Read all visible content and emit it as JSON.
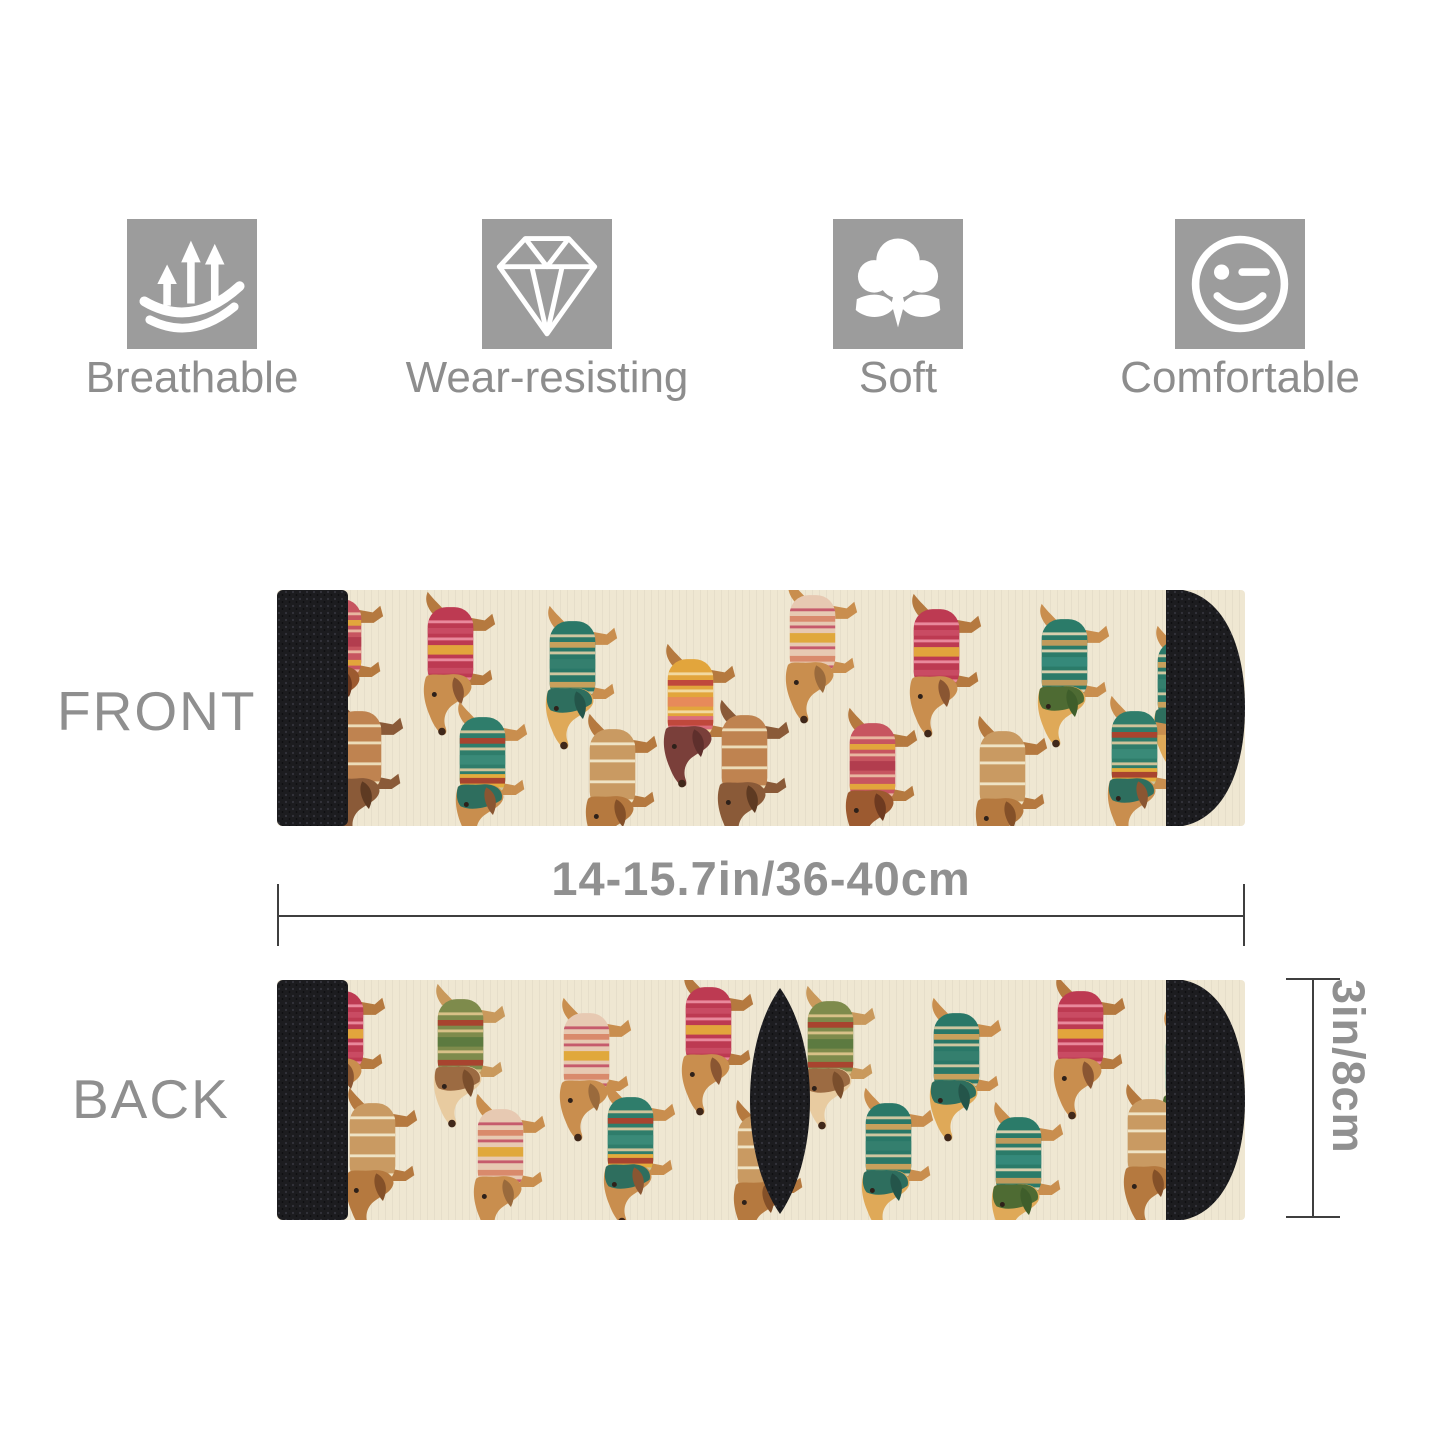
{
  "features": [
    {
      "label": "Breathable",
      "icon": "breathable-arrows-icon"
    },
    {
      "label": "Wear-resisting",
      "icon": "diamond-icon"
    },
    {
      "label": "Soft",
      "icon": "cotton-flower-icon"
    },
    {
      "label": "Comfortable",
      "icon": "wink-smiley-icon"
    }
  ],
  "front_label": "FRONT",
  "back_label": "BACK",
  "width_dimension": "14-15.7in/36-40cm",
  "height_dimension": "3in/8cm",
  "colors": {
    "icon_bg": "#9c9c9c",
    "icon_glyph": "#ffffff",
    "label_text": "#8d8d8d",
    "side_label_text": "#8f8f8f",
    "dimension_text": "#909090",
    "dimension_line": "#3f3f3f",
    "sock_base": "#efe7d2",
    "sock_black": "#1c1c1f"
  },
  "sock_pattern": {
    "dog_size": [
      95,
      152
    ],
    "variants": {
      "red": {
        "body": "#bd3a52",
        "blk": "none",
        "s1": "#e9899c",
        "s2": "#c94b63",
        "s3": "#e2a53c",
        "fur": "#b5793f",
        "head": "#c98e4e",
        "ear": "#8a5632",
        "hood": "none"
      },
      "teal": {
        "body": "#2b7b69",
        "blk": "none",
        "s1": "#d8cfae",
        "s2": "#bf9a5c",
        "s3": "#35897a",
        "fur": "#c98e4e",
        "head": "#dfa958",
        "ear": "#3f5e2b",
        "hood": "#4e6b33"
      },
      "tealhood": {
        "body": "#2a7868",
        "blk": "none",
        "s1": "#cfc6a0",
        "s2": "#c8a05c",
        "s3": "#347f6e",
        "fur": "#c98e4e",
        "head": "#dfa958",
        "ear": "#24554a",
        "hood": "#2e6e5e"
      },
      "tealyellow": {
        "body": "#2f7d6b",
        "blk": "#e3ac3c",
        "s1": "#cfc39a",
        "s2": "#a8442f",
        "s3": "#3a8a78",
        "fur": "#c98e4e",
        "head": "#c98e4e",
        "ear": "#8a5632",
        "hood": "#2e6e5e"
      },
      "yellow": {
        "body": "#e2a53c",
        "blk": "#db6d7c",
        "s1": "#f2d9a0",
        "s2": "#c0483c",
        "s3": "#e78a5a",
        "fur": "#b5793f",
        "head": "#7a3f3a",
        "ear": "#5e2f2c",
        "hood": "none"
      },
      "cream": {
        "body": "#e7c9b2",
        "blk": "none",
        "s1": "#c65b6c",
        "s2": "#d98a6c",
        "s3": "#e0a83c",
        "fur": "#c98e4e",
        "head": "#c98e4e",
        "ear": "#9a6a3c",
        "hood": "none"
      },
      "olive": {
        "body": "#7e8b4c",
        "blk": "none",
        "s1": "#d8c188",
        "s2": "#a8442f",
        "s3": "#5c7a40",
        "fur": "#c9995c",
        "head": "#e8cba0",
        "ear": "#7a4e2c",
        "hood": "#9c6b42"
      },
      "brownplain": {
        "body": "#bf8350",
        "blk": "none",
        "s1": "#ecdcb8",
        "s2": "none",
        "s3": "none",
        "fur": "#8a5a38",
        "head": "#8a5a38",
        "ear": "#5e3a22",
        "hood": "none"
      },
      "tan": {
        "body": "#c99a62",
        "blk": "none",
        "s1": "#efe3c4",
        "s2": "none",
        "s3": "none",
        "fur": "#b5793f",
        "head": "#b5793f",
        "ear": "#845028",
        "hood": "none"
      },
      "redpink": {
        "body": "#c75560",
        "blk": "none",
        "s1": "#e8b6a0",
        "s2": "#e2a53c",
        "s3": "#b23d4e",
        "fur": "#b5793f",
        "head": "#9c5a30",
        "ear": "#6e3a20",
        "hood": "none"
      }
    },
    "front_dogs": [
      [
        14,
        -8,
        "redpink"
      ],
      [
        126,
        0,
        "red"
      ],
      [
        248,
        14,
        "tealhood"
      ],
      [
        366,
        52,
        "yellow"
      ],
      [
        488,
        -12,
        "cream"
      ],
      [
        612,
        2,
        "red"
      ],
      [
        740,
        12,
        "teal"
      ],
      [
        856,
        34,
        "tealhood"
      ],
      [
        34,
        104,
        "brownplain"
      ],
      [
        158,
        110,
        "tealyellow"
      ],
      [
        288,
        122,
        "tan"
      ],
      [
        420,
        108,
        "brownplain"
      ],
      [
        548,
        116,
        "redpink"
      ],
      [
        678,
        124,
        "tan"
      ],
      [
        810,
        104,
        "tealyellow"
      ]
    ],
    "back_dogs": [
      [
        16,
        -6,
        "red"
      ],
      [
        136,
        2,
        "olive"
      ],
      [
        262,
        16,
        "cream"
      ],
      [
        384,
        -10,
        "red"
      ],
      [
        506,
        4,
        "olive"
      ],
      [
        632,
        16,
        "tealhood"
      ],
      [
        756,
        -6,
        "red"
      ],
      [
        864,
        30,
        "teal"
      ],
      [
        48,
        106,
        "tan"
      ],
      [
        176,
        112,
        "cream"
      ],
      [
        306,
        100,
        "tealyellow"
      ],
      [
        436,
        118,
        "tan"
      ],
      [
        564,
        106,
        "tealhood"
      ],
      [
        694,
        120,
        "teal"
      ],
      [
        826,
        102,
        "tan"
      ]
    ]
  }
}
